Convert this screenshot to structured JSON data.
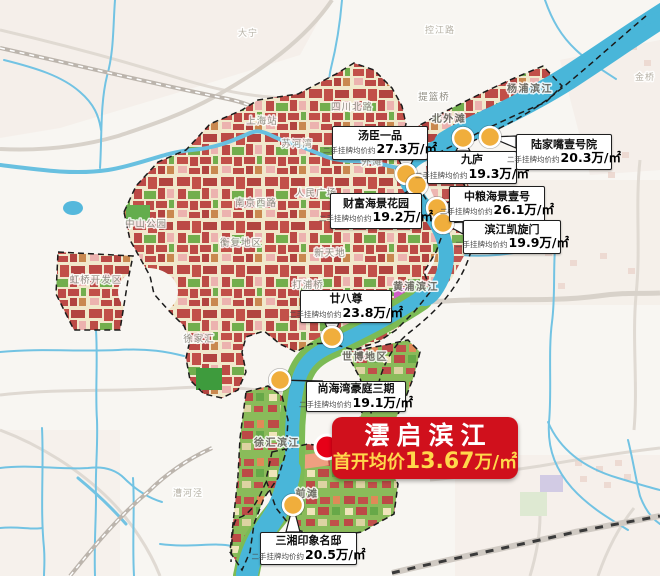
{
  "banner": {
    "title": "澐启滨江",
    "price_prefix": "首开均价",
    "price": "13.67",
    "price_unit": "万/㎡",
    "x": 332,
    "y": 417,
    "w": 186,
    "h": 62,
    "marker": {
      "x": 327,
      "y": 447
    }
  },
  "callouts": [
    {
      "name": "汤臣一品",
      "prefix": "二手挂牌均价约",
      "price": "27.3",
      "unit": "万/㎡",
      "x": 332,
      "y": 126,
      "w": 96,
      "h": 34,
      "mx": 406,
      "my": 174
    },
    {
      "name": "九庐",
      "prefix": "二手挂牌均价约",
      "price": "19.3",
      "unit": "万/㎡",
      "x": 427,
      "y": 151,
      "w": 90,
      "h": 33,
      "mx": 463,
      "my": 138
    },
    {
      "name": "陆家嘴壹号院",
      "prefix": "二手挂牌均价约",
      "price": "20.3",
      "unit": "万/㎡",
      "x": 516,
      "y": 134,
      "w": 96,
      "h": 36,
      "mx": 490,
      "my": 137
    },
    {
      "name": "中粮海景壹号",
      "prefix": "二手挂牌均价约",
      "price": "26.1",
      "unit": "万/㎡",
      "x": 449,
      "y": 186,
      "w": 96,
      "h": 36,
      "mx": 437,
      "my": 208
    },
    {
      "name": "滨江凯旋门",
      "prefix": "二手挂牌均价约",
      "price": "19.9",
      "unit": "万/㎡",
      "x": 463,
      "y": 220,
      "w": 98,
      "h": 34,
      "mx": 443,
      "my": 223
    },
    {
      "name": "财富海景花园",
      "prefix": "二手挂牌均价约",
      "price": "19.2",
      "unit": "万/㎡",
      "x": 330,
      "y": 193,
      "w": 92,
      "h": 36,
      "mx": 417,
      "my": 185
    },
    {
      "name": "廿八尊",
      "prefix": "二手挂牌均价约",
      "price": "23.8",
      "unit": "万/㎡",
      "x": 300,
      "y": 290,
      "w": 92,
      "h": 33,
      "mx": 332,
      "my": 337
    },
    {
      "name": "尚海湾豪庭三期",
      "prefix": "二手挂牌均价约",
      "price": "19.1",
      "unit": "万/㎡",
      "x": 306,
      "y": 381,
      "w": 100,
      "h": 31,
      "mx": 280,
      "my": 380
    },
    {
      "name": "三湘印象名邸",
      "prefix": "二手挂牌均价约",
      "price": "20.5",
      "unit": "万/㎡",
      "x": 260,
      "y": 532,
      "w": 97,
      "h": 33,
      "mx": 293,
      "my": 505
    }
  ],
  "map_labels": [
    {
      "text": "大宁",
      "x": 248,
      "y": 36,
      "style": "faint"
    },
    {
      "text": "控江路",
      "x": 440,
      "y": 33,
      "style": "faint"
    },
    {
      "text": "金桥",
      "x": 645,
      "y": 80,
      "style": "faint"
    },
    {
      "text": "四川北路",
      "x": 352,
      "y": 110,
      "style": "normal"
    },
    {
      "text": "上海站",
      "x": 262,
      "y": 124,
      "style": "normal"
    },
    {
      "text": "提篮桥",
      "x": 434,
      "y": 100,
      "style": "normal"
    },
    {
      "text": "杨浦滨江",
      "x": 530,
      "y": 92,
      "style": "strong"
    },
    {
      "text": "北外滩",
      "x": 449,
      "y": 122,
      "style": "strong"
    },
    {
      "text": "苏河湾",
      "x": 297,
      "y": 147,
      "style": "normal"
    },
    {
      "text": "外滩",
      "x": 372,
      "y": 165,
      "style": "normal"
    },
    {
      "text": "人民广场",
      "x": 316,
      "y": 196,
      "style": "normal"
    },
    {
      "text": "南京西路",
      "x": 256,
      "y": 206,
      "style": "normal"
    },
    {
      "text": "中山公园",
      "x": 146,
      "y": 227,
      "style": "normal"
    },
    {
      "text": "衡复地区",
      "x": 241,
      "y": 246,
      "style": "normal"
    },
    {
      "text": "新天地",
      "x": 330,
      "y": 256,
      "style": "normal"
    },
    {
      "text": "打浦桥",
      "x": 308,
      "y": 288,
      "style": "normal"
    },
    {
      "text": "黄浦滨江",
      "x": 416,
      "y": 290,
      "style": "strong"
    },
    {
      "text": "徐家汇",
      "x": 199,
      "y": 342,
      "style": "normal"
    },
    {
      "text": "世博地区",
      "x": 365,
      "y": 360,
      "style": "strong"
    },
    {
      "text": "徐汇滨江",
      "x": 277,
      "y": 446,
      "style": "strong"
    },
    {
      "text": "前滩",
      "x": 307,
      "y": 497,
      "style": "strong"
    },
    {
      "text": "虹桥开发区",
      "x": 96,
      "y": 283,
      "style": "normal"
    },
    {
      "text": "漕河泾",
      "x": 188,
      "y": 496,
      "style": "faint"
    }
  ],
  "colors": {
    "banner_bg": "#d0101c",
    "banner_gold": "#ffd84b",
    "marker_yellow": "#f0ae3c",
    "marker_red": "#e60018",
    "river": "#49b6d9",
    "boundary": "#1b1b1b"
  }
}
